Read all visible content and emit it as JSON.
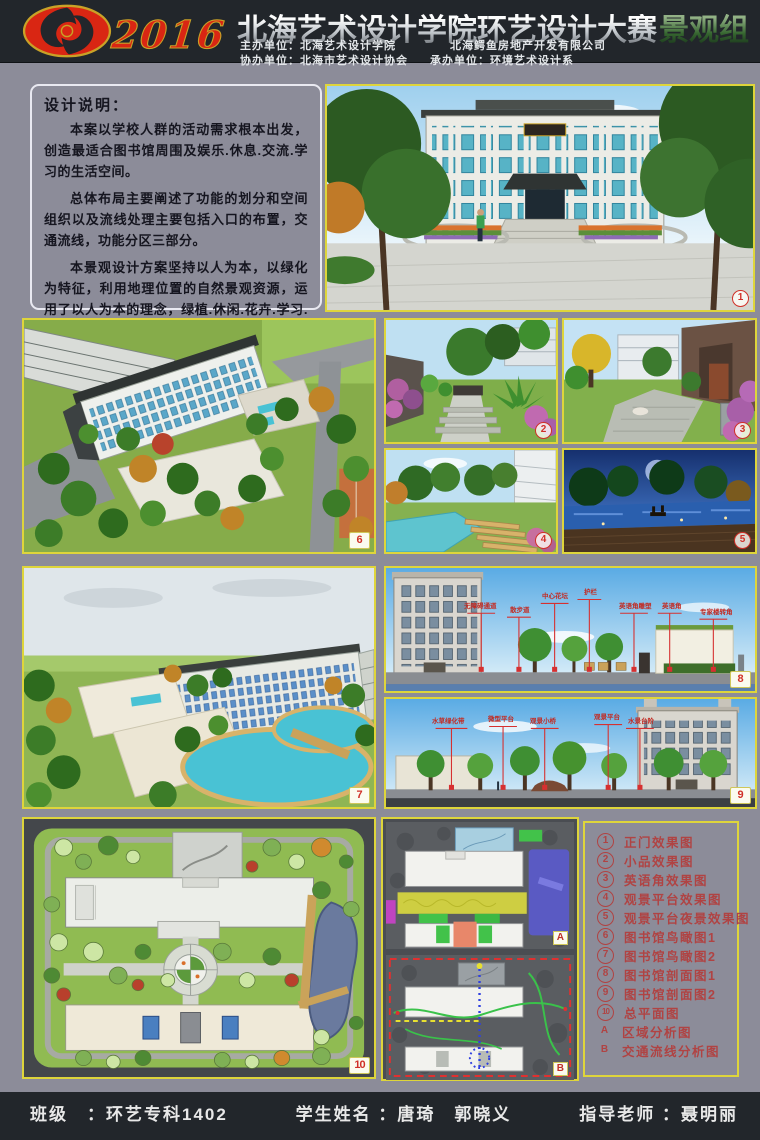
{
  "header": {
    "year": "2016",
    "title": "北海艺术设计学院环艺设计大赛",
    "title_group": "景观组",
    "org1_label": "主办单位：",
    "org1_a": "北海艺术设计学院",
    "org1_b": "北海鳄鱼房地产开发有限公司",
    "org2_label": "协办单位：",
    "org2_a": "北海市艺术设计协会",
    "org2b_label": "承办单位：",
    "org2_b": "环境艺术设计系"
  },
  "description": {
    "heading": "设计说明：",
    "p1": "本案以学校人群的活动需求根本出发，创造最适合图书馆周围及娱乐.休息.交流.学习的生活空间。",
    "p2": "总体布局主要阐述了功能的划分和空间组织以及流线处理主要包括入口的布置，交通流线，功能分区三部分。",
    "p3": "本景观设计方案坚持以人为本，以绿化为特征，利用地理位置的自然景观资源，运用了以人为本的理念，绿植.休闲.花卉.学习.构成了特色的校园环境。"
  },
  "renders": {
    "r1": {
      "badge": "1"
    },
    "r2": {
      "badge": "2"
    },
    "r3": {
      "badge": "3"
    },
    "r4": {
      "badge": "4"
    },
    "r5": {
      "badge": "5"
    },
    "r6": {
      "badge": "6"
    },
    "r7": {
      "badge": "7"
    },
    "r8": {
      "badge": "8",
      "callouts": [
        "无障碍通道",
        "散步道",
        "中心花坛",
        "护栏",
        "英语角雕塑",
        "英语角",
        "专家楼转角"
      ]
    },
    "r9": {
      "badge": "9",
      "callouts": [
        "水草绿化带",
        "微型平台",
        "观景小桥",
        "观景平台",
        "水景台阶"
      ]
    },
    "r10": {
      "badge": "10"
    },
    "ra": {
      "badge": "A"
    },
    "rb": {
      "badge": "B"
    }
  },
  "legend": {
    "items": [
      {
        "num": "1",
        "label": "正门效果图"
      },
      {
        "num": "2",
        "label": "小品效果图"
      },
      {
        "num": "3",
        "label": "英语角效果图"
      },
      {
        "num": "4",
        "label": "观景平台效果图"
      },
      {
        "num": "5",
        "label": "观景平台夜景效果图"
      },
      {
        "num": "6",
        "label": "图书馆鸟瞰图1"
      },
      {
        "num": "7",
        "label": "图书馆鸟瞰图2"
      },
      {
        "num": "8",
        "label": "图书馆剖面图1"
      },
      {
        "num": "9",
        "label": "图书馆剖面图2"
      },
      {
        "num": "10",
        "label": "总平面图"
      },
      {
        "num": "A",
        "label": "区域分析图"
      },
      {
        "num": "B",
        "label": "交通流线分析图"
      }
    ]
  },
  "footer": {
    "class_label": "班级　：",
    "class_value": "环艺专科1402",
    "students_label": "学生姓名 ：",
    "students_value": "唐琦　郭晓义",
    "teacher_label": "指导老师 ：",
    "teacher_value": "聂明丽"
  },
  "colors": {
    "background": "#8c8c99",
    "header_bg": "#22262b",
    "frame_border": "#ded53b",
    "legend_text": "#b04343",
    "title_green": "#2f6132",
    "logo_red": "#d92613"
  }
}
